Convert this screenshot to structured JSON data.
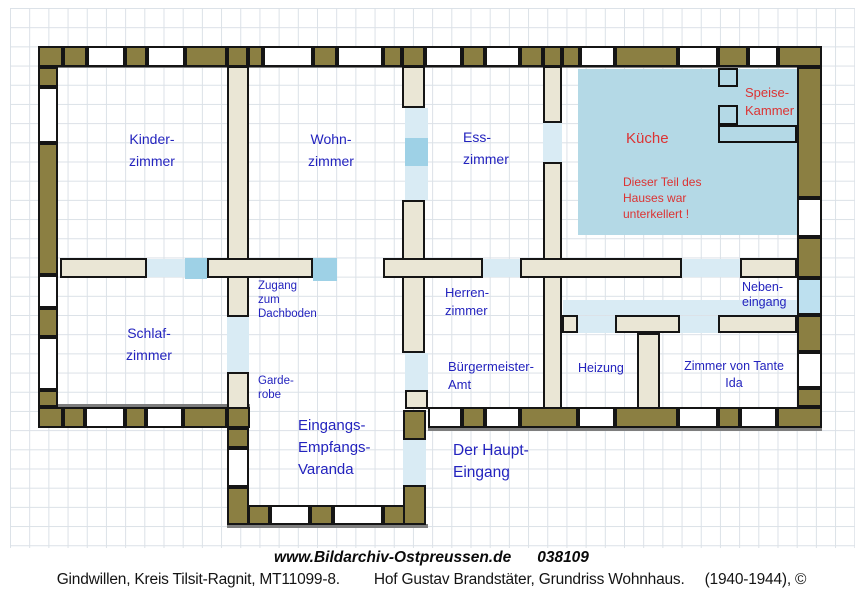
{
  "title": "Grundriss Wohnhaus floor plan",
  "colors": {
    "blue_label": "#2323BE",
    "red_label": "#DC3333",
    "wall_olive": "#8B7F42",
    "wall_border": "#151515",
    "interior_wall": "#EAE6D5",
    "kitchen_fill": "#B4D9E6",
    "door_pale": "#D9EBF4",
    "door_bright": "#9ED1E6",
    "door_light": "#BDE0EF",
    "wall_gray_line": "#7E7E7E",
    "grid_line": "#DBE1E7"
  },
  "rooms": [
    {
      "id": "kinderzimmer",
      "color": "blue_label",
      "lines": [
        "Kinder-",
        "zimmer"
      ]
    },
    {
      "id": "wohnzimmer",
      "color": "blue_label",
      "lines": [
        "Wohn-",
        "zimmer"
      ]
    },
    {
      "id": "esszimmer",
      "color": "blue_label",
      "lines": [
        "Ess-",
        "zimmer"
      ]
    },
    {
      "id": "kueche",
      "color": "red_label",
      "lines": [
        "Küche"
      ]
    },
    {
      "id": "speisekammer",
      "color": "red_label",
      "lines": [
        "Speise-",
        "Kammer"
      ]
    },
    {
      "id": "kellernote",
      "color": "red_label",
      "lines": [
        "Dieser Teil des",
        "Hauses war",
        "unterkellert !"
      ]
    },
    {
      "id": "zugang",
      "color": "blue_label",
      "lines": [
        "Zugang",
        "zum",
        "Dachboden"
      ]
    },
    {
      "id": "herrenzimmer",
      "color": "blue_label",
      "lines": [
        "Herren-",
        "zimmer"
      ]
    },
    {
      "id": "nebeneingang",
      "color": "blue_label",
      "lines": [
        "Neben-",
        "eingang"
      ]
    },
    {
      "id": "schlafzimmer",
      "color": "blue_label",
      "lines": [
        "Schlaf-",
        "zimmer"
      ]
    },
    {
      "id": "garderobe",
      "color": "blue_label",
      "lines": [
        "Garde-",
        "robe"
      ]
    },
    {
      "id": "buergermeisteramt",
      "color": "blue_label",
      "lines": [
        "Bürgermeister-",
        "Amt"
      ]
    },
    {
      "id": "heizung",
      "color": "blue_label",
      "lines": [
        "Heizung"
      ]
    },
    {
      "id": "tanteida",
      "color": "blue_label",
      "lines": [
        "Zimmer von Tante",
        "Ida"
      ]
    },
    {
      "id": "veranda",
      "color": "blue_label",
      "lines": [
        "Eingangs-",
        "Empfangs-",
        "Varanda"
      ]
    },
    {
      "id": "haupteingang",
      "color": "blue_label",
      "lines": [
        "Der Haupt-",
        "Eingang"
      ]
    }
  ],
  "caption": {
    "site": "www.Bildarchiv-Ostpreussen.de",
    "number": "038109",
    "location": "Gindwillen, Kreis Tilsit-Ragnit, MT11099-8.",
    "subject": "Hof Gustav Brandstäter, Grundriss Wohnhaus.",
    "years": "(1940-1944), ©"
  }
}
